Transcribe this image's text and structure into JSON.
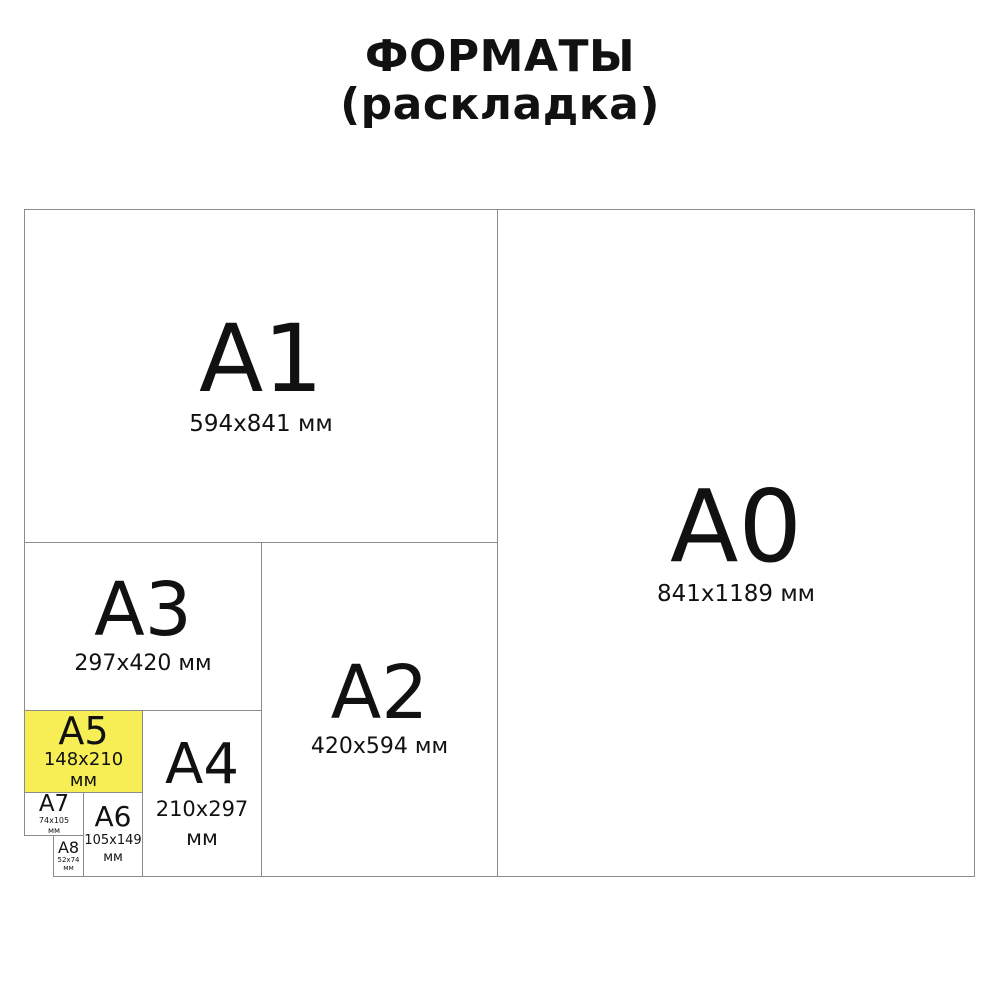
{
  "title": {
    "line1": "ФОРМАТЫ",
    "line2": "(раскладка)"
  },
  "colors": {
    "background": "#FFFFFF",
    "text": "#111111",
    "border": "#8B8B8B",
    "highlight_fill": "#F7EE55"
  },
  "formats": {
    "a0": {
      "label": "A0",
      "size": "841x1189 мм",
      "highlighted": false
    },
    "a1": {
      "label": "A1",
      "size": "594x841 мм",
      "highlighted": false
    },
    "a2": {
      "label": "A2",
      "size": "420x594 мм",
      "highlighted": false
    },
    "a3": {
      "label": "A3",
      "size": "297x420 мм",
      "highlighted": false
    },
    "a4": {
      "label": "A4",
      "size_line1": "210x297",
      "size_line2": "мм",
      "highlighted": false
    },
    "a5": {
      "label": "A5",
      "size_line1": "148x210",
      "size_line2": "мм",
      "highlighted": true
    },
    "a6": {
      "label": "A6",
      "size_line1": "105x149",
      "size_line2": "мм",
      "highlighted": false
    },
    "a7": {
      "label": "A7",
      "size_line1": "74x105",
      "size_line2": "мм",
      "highlighted": false
    },
    "a8": {
      "label": "A8",
      "size_line1": "52x74",
      "size_line2": "мм",
      "highlighted": false
    }
  }
}
